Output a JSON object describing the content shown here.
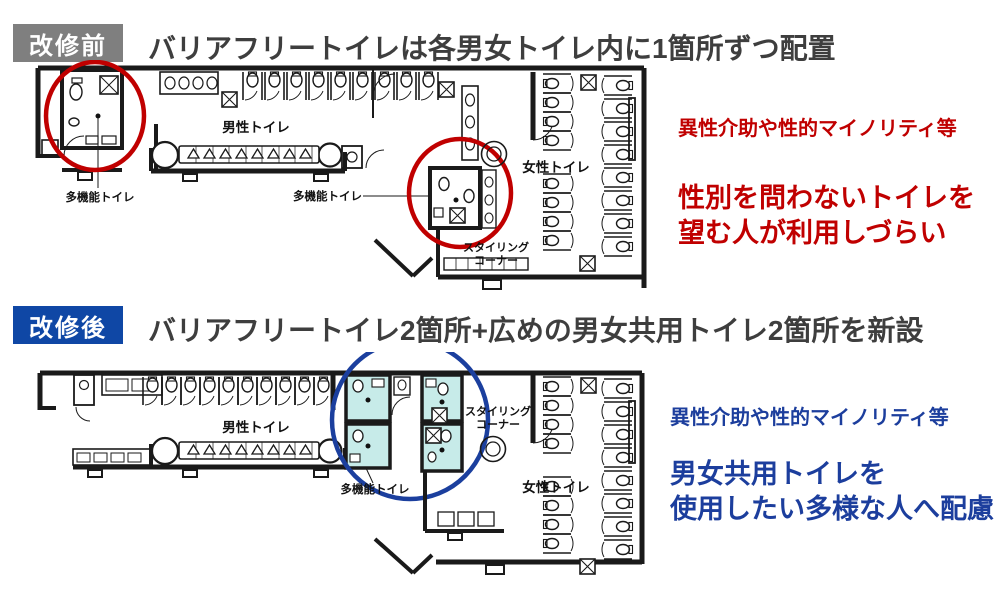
{
  "colors": {
    "badge_before_bg": "#7f7f7f",
    "badge_after_bg": "#0f47a5",
    "heading_text": "#3e3e3e",
    "accent_red": "#c00000",
    "accent_blue": "#1c3e9d",
    "highlight_teal": "#c7ebe9"
  },
  "before": {
    "badge": "改修前",
    "heading": "バリアフリートイレは各男女トイレ内に1箇所ずつ配置",
    "note_small": "異性介助や性的マイノリティ等",
    "note_big_line1": "性別を問わないトイレを",
    "note_big_line2": "望む人が利用しづらい",
    "plan": {
      "mens": "男性トイレ",
      "womens": "女性トイレ",
      "multi_left": "多機能トイレ",
      "multi_mid": "多機能トイレ",
      "styling_line1": "スタイリング",
      "styling_line2": "コーナー"
    }
  },
  "after": {
    "badge": "改修後",
    "heading": "バリアフリートイレ2箇所+広めの男女共用トイレ2箇所を新設",
    "note_small": "異性介助や性的マイノリティ等",
    "note_big_line1": "男女共用トイレを",
    "note_big_line2": "使用したい多様な人へ配慮",
    "plan": {
      "mens": "男性トイレ",
      "womens": "女性トイレ",
      "multi": "多機能トイレ",
      "styling_line1": "スタイリング",
      "styling_line2": "コーナー"
    }
  }
}
